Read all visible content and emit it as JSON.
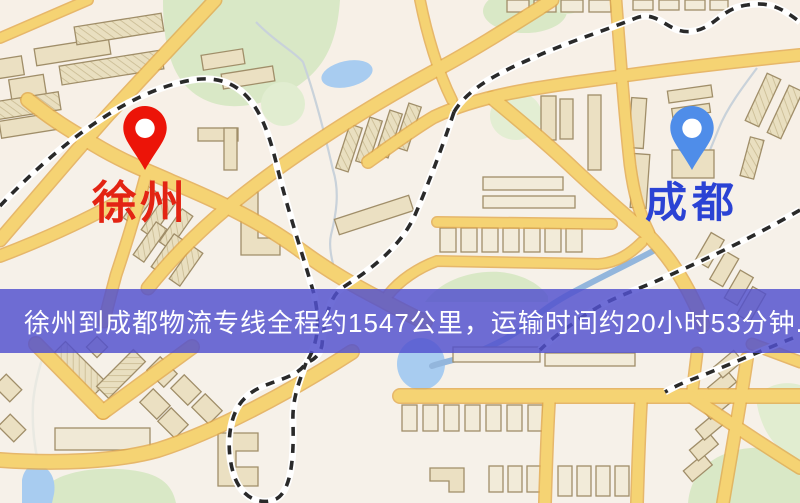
{
  "map_overlay": {
    "banner": {
      "text": "徐州到成都物流专线全程约1547公里，运输时间约20小时53分钟.",
      "background_color": "#5250ce",
      "text_color": "#ffffff"
    },
    "origin_marker": {
      "label": "徐州",
      "pin_color": "#ec1408",
      "label_color": "#e32413"
    },
    "destination_marker": {
      "label": "成都",
      "pin_color": "#4f8de9",
      "label_color": "#2b43d4"
    },
    "route": {
      "distance_text": "约1547公里",
      "duration_text": "约20小时53分钟"
    }
  },
  "map_palette": {
    "background": "#f6f1e9",
    "road_fill": "#f5d373",
    "road_casing": "#e2a94b",
    "building": "#ebe0c2",
    "park": "#d9e8c6",
    "water": "#a8ccf0",
    "railway": "#2a2a2a"
  }
}
